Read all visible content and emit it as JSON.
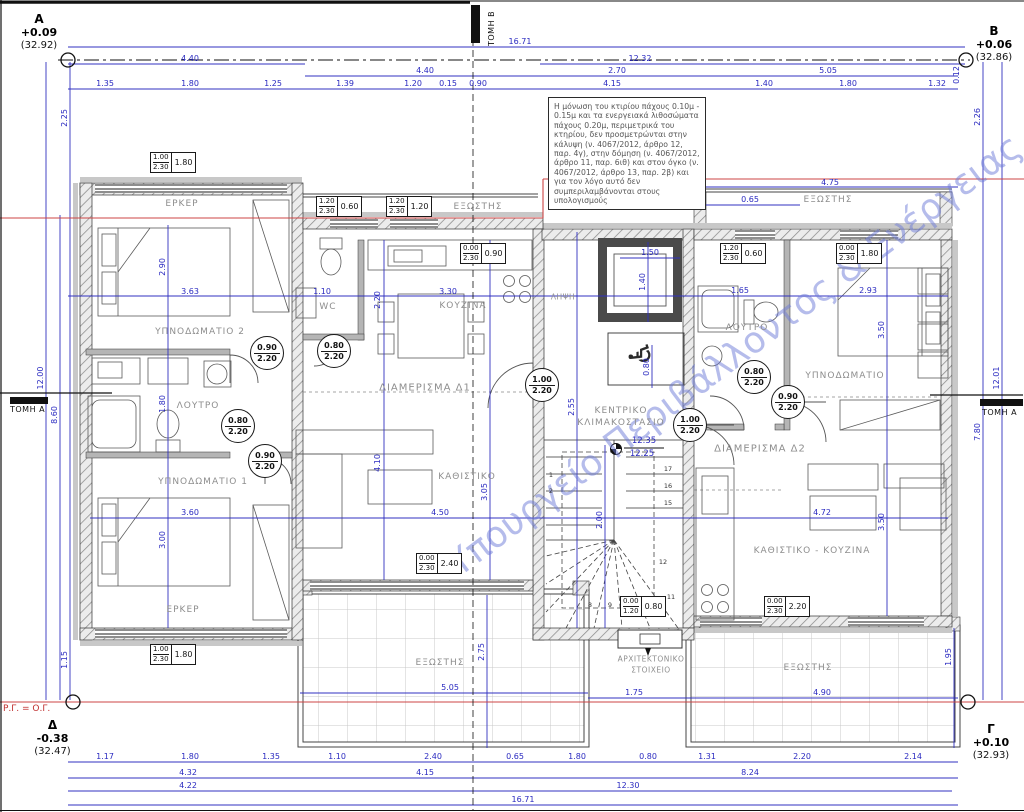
{
  "note": "Η μόνωση του κτιρίου πάχους 0.10μ - 0.15μ και τα ενεργειακά λιθοσώματα πάχους 0.20μ, περιμετρικά του κτηρίου, δεν προσμετρώνται στην κάλυψη (ν. 4067/2012, άρθρο 12, παρ. 4γ), στην δόμηση (ν. 4067/2012, άρθρο 11, παρ. 6ιθ) και στον όγκο (ν. 4067/2012, άρθρο 13, παρ. 2β) και για τον λόγο αυτό δεν συμπεριλαμβάνονται στους υπολογισμούς",
  "watermark": "Υπουργείο Περιβάλλοντος & Ενέργειας",
  "red_label": "Ρ.Γ. = Ο.Γ.",
  "corners": {
    "a": {
      "letter": "A",
      "level": "+0.09",
      "abs": "(32.92)"
    },
    "b": {
      "letter": "B",
      "level": "+0.06",
      "abs": "(32.86)"
    },
    "c": {
      "letter": "Γ",
      "level": "+0.10",
      "abs": "(32.93)"
    },
    "d": {
      "letter": "Δ",
      "level": "-0.38",
      "abs": "(32.47)"
    }
  },
  "sections": {
    "left": "ΤΟΜΗ Α",
    "right": "ΤΟΜΗ Α",
    "top": "ΤΟΜΗ Β"
  },
  "rooms": {
    "erker_top": "ΕΡΚΕΡ",
    "bedroom2": "ΥΠΝΟΔΩΜΑΤΙΟ 2",
    "bath1": "ΛΟΥΤΡΟ",
    "bedroom1": "ΥΠΝΟΔΩΜΑΤΙΟ 1",
    "erker_bottom": "ΕΡΚΕΡ",
    "wc": "WC",
    "kitchen1": "ΚΟΥΖΙΝΑ",
    "apartment1": "ΔΙΑΜΕΡΙΣΜΑ Δ1",
    "living1": "ΚΑΘΙΣΤΙΚΟ",
    "stair1": "ΚΕΝΤΡΙΚΟ",
    "stair2": "ΚΛΙΜΑΚΟΣΤΑΣΙΟ",
    "bath2": "ΛΟΥΤΡΟ",
    "bedroom_r": "ΥΠΝΟΔΩΜΑΤΙΟ",
    "apartment2": "ΔΙΑΜΕΡΙΣΜΑ Δ2",
    "living_kitchen2": "ΚΑΘΙΣΤΙΚΟ - ΚΟΥΖΙΝΑ",
    "balcony_tl": "ΕΞΩΣΤΗΣ",
    "balcony_tr": "ΕΞΩΣΤΗΣ",
    "balcony_bl": "ΕΞΩΣΤΗΣ",
    "balcony_br": "ΕΞΩΣΤΗΣ",
    "arch1": "ΑΡΧΙΤΕΚΤΟΝΙΚΟ",
    "arch2": "ΣΤΟΙΧΕΙΟ",
    "lipsi": "ΛΗΨΗ"
  },
  "dims": {
    "top": [
      "16.71",
      "4.40",
      "12.32",
      "4.40",
      "2.70",
      "5.05",
      "0.12",
      "1.35",
      "1.80",
      "1.25",
      "1.39",
      "1.20",
      "0.15",
      "0.90",
      "4.15",
      "1.40",
      "1.80",
      "1.32"
    ],
    "bottom": [
      "1.17",
      "1.80",
      "1.35",
      "1.10",
      "2.40",
      "0.65",
      "1.80",
      "0.80",
      "1.31",
      "2.20",
      "2.14",
      "4.32",
      "4.15",
      "8.24",
      "4.22",
      "12.30",
      "16.71"
    ],
    "left": [
      "2.25",
      "12.00",
      "8.60",
      "1.15"
    ],
    "right": [
      "2.26",
      "12.01",
      "7.80",
      "1.95"
    ],
    "interior": [
      "2.90",
      "3.63",
      "1.10",
      "2.20",
      "3.30",
      "4.50",
      "4.10",
      "3.05",
      "1.80",
      "3.60",
      "3.00",
      "2.55",
      "2.00",
      "1.65",
      "2.93",
      "3.50",
      "3.50",
      "4.72",
      "1.50",
      "1.40",
      "0.80",
      "5.05",
      "2.75",
      "1.75",
      "4.90",
      "4.75",
      "0.65"
    ],
    "levels": {
      "upper": "12.35",
      "lower": "12.25"
    }
  },
  "door_tags": [
    {
      "w": "0.90",
      "h": "2.20"
    },
    {
      "w": "0.80",
      "h": "2.20"
    },
    {
      "w": "0.80",
      "h": "2.20"
    },
    {
      "w": "0.90",
      "h": "2.20"
    },
    {
      "w": "1.00",
      "h": "2.20"
    },
    {
      "w": "1.00",
      "h": "2.20"
    },
    {
      "w": "0.80",
      "h": "2.20"
    },
    {
      "w": "0.90",
      "h": "2.20"
    }
  ],
  "window_tags": [
    {
      "a": "1.00",
      "b": "2.30",
      "c": "1.80"
    },
    {
      "a": "1.20",
      "b": "2.30",
      "c": "0.60"
    },
    {
      "a": "1.20",
      "b": "2.30",
      "c": "1.20"
    },
    {
      "a": "0.00",
      "b": "2.30",
      "c": "0.90"
    },
    {
      "a": "1.20",
      "b": "2.30",
      "c": "0.60"
    },
    {
      "a": "0.00",
      "b": "2.30",
      "c": "1.80"
    },
    {
      "a": "0.00",
      "b": "2.30",
      "c": "2.40"
    },
    {
      "a": "0.00",
      "b": "1.20",
      "c": "0.80"
    },
    {
      "a": "0.00",
      "b": "2.30",
      "c": "2.20"
    },
    {
      "a": "1.00",
      "b": "2.30",
      "c": "1.80"
    }
  ],
  "stair_numbers": [
    "1",
    "2",
    "8",
    "9",
    "11",
    "12",
    "15",
    "16",
    "17"
  ],
  "icons": {
    "wheelchair": "♿"
  },
  "colors": {
    "dimension": "#2a2ac0",
    "property_line": "#cc4444",
    "watermark": "#6c7ad8",
    "wall_hatch": "#8a8a8a"
  }
}
